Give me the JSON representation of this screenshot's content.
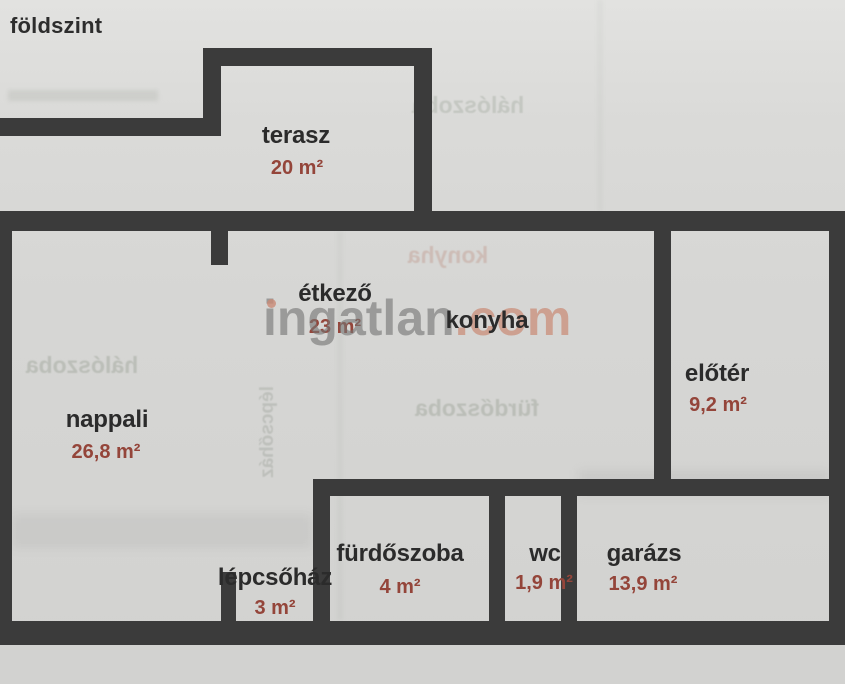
{
  "floor_title": "földszint",
  "watermark": {
    "name": "ingatlan.com",
    "part1": "ingatlan",
    "part2": ".com",
    "gray_color": "#767674",
    "accent_color": "#c98a76"
  },
  "rooms": {
    "terasz": {
      "name": "terasz",
      "area": "20 m²"
    },
    "etkezo": {
      "name": "étkező",
      "area": "23 m²"
    },
    "konyha": {
      "name": "konyha"
    },
    "nappali": {
      "name": "nappali",
      "area": "26,8 m²"
    },
    "eloter": {
      "name": "előtér",
      "area": "9,2 m²"
    },
    "lepcsohaz": {
      "name": "lépcsőház",
      "area": "3 m²"
    },
    "furdoszoba": {
      "name": "fürdőszoba",
      "area": "4 m²"
    },
    "wc": {
      "name": "wc",
      "area": "1,9 m²"
    },
    "garazs": {
      "name": "garázs",
      "area": "13,9 m²"
    }
  },
  "ghost_bleedthrough": {
    "left": "hálószoba",
    "top_right": "hálószoba",
    "center": "fürdőszoba",
    "kitchen": "konyha",
    "stairs": "lépcsőház"
  },
  "colors": {
    "wall": "#3b3b3b",
    "paper": "#d6d6d4",
    "room_label": "#2b2b2b",
    "area_label": "#94453a"
  }
}
